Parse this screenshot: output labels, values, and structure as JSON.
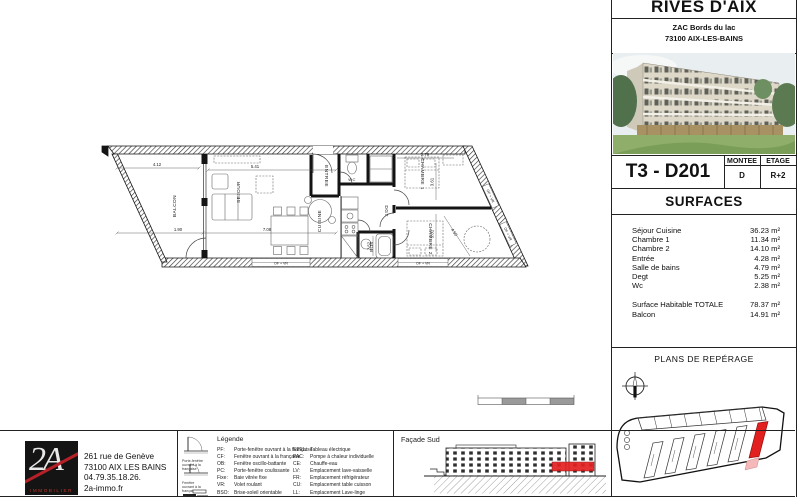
{
  "project": {
    "name": "RIVES D'AIX",
    "address1": "ZAC Bords du lac",
    "address2": "73100 AIX-LES-BAINS"
  },
  "unit": {
    "code": "T3 - D201",
    "montee_label": "MONTEE",
    "montee": "D",
    "etage_label": "ETAGE",
    "etage": "R+2"
  },
  "surfaces": {
    "title": "SURFACES",
    "rows": [
      {
        "label": "Séjour Cuisine",
        "value": "36.23 m²"
      },
      {
        "label": "Chambre 1",
        "value": "11.34 m²"
      },
      {
        "label": "Chambre 2",
        "value": "14.10 m²"
      },
      {
        "label": "Entrée",
        "value": "4.28 m²"
      },
      {
        "label": "Salle de bains",
        "value": "4.79 m²"
      },
      {
        "label": "Degt",
        "value": "5.25 m²"
      },
      {
        "label": "Wc",
        "value": "2.38 m²"
      }
    ],
    "totals": [
      {
        "label": "Surface Habitable  TOTALE",
        "value": "78.37 m²"
      },
      {
        "label": "Balcon",
        "value": "14.91 m²"
      }
    ]
  },
  "reperage": {
    "title": "PLANS DE REPÉRAGE"
  },
  "facade": {
    "title": "Façade Sud"
  },
  "agency": {
    "logo_main": "2A",
    "logo_sub": "IMMOBILIER",
    "line1": "261 rue de Genève",
    "line2": "73100 AIX LES BAINS",
    "line3": "04.79.35.18.26.",
    "line4": "2a-immo.fr"
  },
  "legend": {
    "title": "Légende",
    "icon_cap1": "Porte-fenêtre\nouvrant à la française",
    "icon_cap2": "Fenêtre\nouvrant à la française",
    "col1": [
      {
        "abbr": "PF:",
        "desc": "Porte-fenêtre ouvrant à la française"
      },
      {
        "abbr": "CF:",
        "desc": "Fenêtre ouvrant à la française"
      },
      {
        "abbr": "OB:",
        "desc": "Fenêtre oscillo-battante"
      },
      {
        "abbr": "PC:",
        "desc": "Porte-fenêtre coulissante"
      },
      {
        "abbr": "Fixe:",
        "desc": "Baie vitrée fixe"
      },
      {
        "abbr": "VR:",
        "desc": "Volet roulant"
      },
      {
        "abbr": "BSO:",
        "desc": "Brise-soleil orientable"
      }
    ],
    "col2": [
      {
        "abbr": "ETEL:",
        "desc": "Tableau électrique"
      },
      {
        "abbr": "PAC:",
        "desc": "Pompe à chaleur individuelle"
      },
      {
        "abbr": "CE:",
        "desc": "Chauffe-eau"
      },
      {
        "abbr": "LV:",
        "desc": "Emplacement lave-vaisselle"
      },
      {
        "abbr": "FR:",
        "desc": "Emplacement réfrigérateur"
      },
      {
        "abbr": "CU:",
        "desc": "Emplacement table cuisson"
      },
      {
        "abbr": "LL:",
        "desc": "Emplacement Lave-linge"
      }
    ]
  },
  "plan": {
    "rooms": {
      "balcon": "BALCON",
      "sejour": "SEJOUR",
      "cuisine": "CUISINE",
      "entree": "ENTREE",
      "wc": "WC",
      "sdb": "SDB",
      "dgt": "DGT",
      "ch1": "CHAMBRE 1",
      "ch2": "CHAMBRE 2"
    },
    "dims": {
      "d1": "4.12",
      "d2": "5.41",
      "d3": "1.90",
      "d4": "7.08",
      "d5": "2.79",
      "d6": "3.61",
      "d7": "3.81",
      "d8": "2.52",
      "d9": "4.50"
    },
    "tags": {
      "t1": "OF + VR",
      "t2": "OF + VR",
      "t3": "OF + VR",
      "t4": "OF + VR"
    }
  },
  "colors": {
    "highlight_red": "#e32020",
    "highlight_pink": "#f5b9b9",
    "logo_red": "#b62128",
    "wall_black": "#141414"
  }
}
